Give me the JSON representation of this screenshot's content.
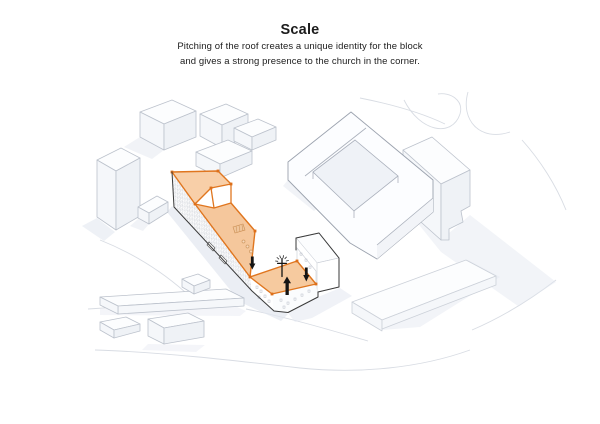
{
  "header": {
    "title": "Scale",
    "subtitle_line1": "Pitching of the roof creates a unique identity for the block",
    "subtitle_line2": "and gives a strong presence to the church in the corner."
  },
  "diagram": {
    "type": "axonometric-massing-diagram",
    "description": "3D axonometric view of a white city-block model. The proposed building's pitched roof is highlighted in orange, sloping down from the tall north-west end to a church with a cross at the street corner; black arrows mark where the roof is pushed down and the church lifted up.",
    "colors": {
      "background": "#ffffff",
      "highlight_stroke": "#e0761f",
      "highlight_fill_high": "#f8cfa8",
      "highlight_fill_slope": "#f5c79c",
      "highlight_fill_church": "#f6ca9f",
      "vertex_node": "#dd6f1a",
      "building_outline": "#3a3a3a",
      "context_outline": "#bcc2cc",
      "shadow": "#e3e7f0",
      "icon_color": "#141414",
      "text_color": "#1c1c1c"
    },
    "icons": {
      "church_cross": "church-cross-icon",
      "lift_center": "arrow-up-icon",
      "push_left": "arrow-down-icon",
      "push_right": "arrow-down-icon"
    }
  }
}
